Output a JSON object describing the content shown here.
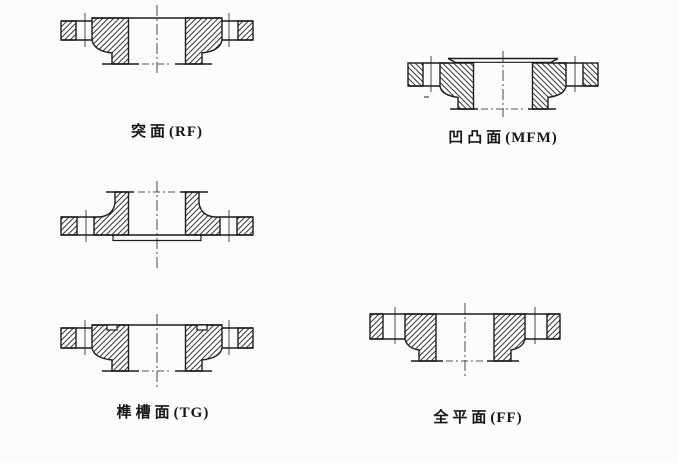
{
  "page": {
    "background_color": "#fcfcfa",
    "line_color": "#1c1c1c",
    "description_visible_text_only": "Flange sealing face types diagram"
  },
  "captions": {
    "rf": {
      "cn": "突面",
      "code": "(RF)"
    },
    "mfm": {
      "cn": "凹凸面",
      "code": "(MFM)"
    },
    "tg": {
      "cn": "榫槽面",
      "code": "(TG)"
    },
    "ff": {
      "cn": "全平面",
      "code": "(FF)"
    }
  }
}
